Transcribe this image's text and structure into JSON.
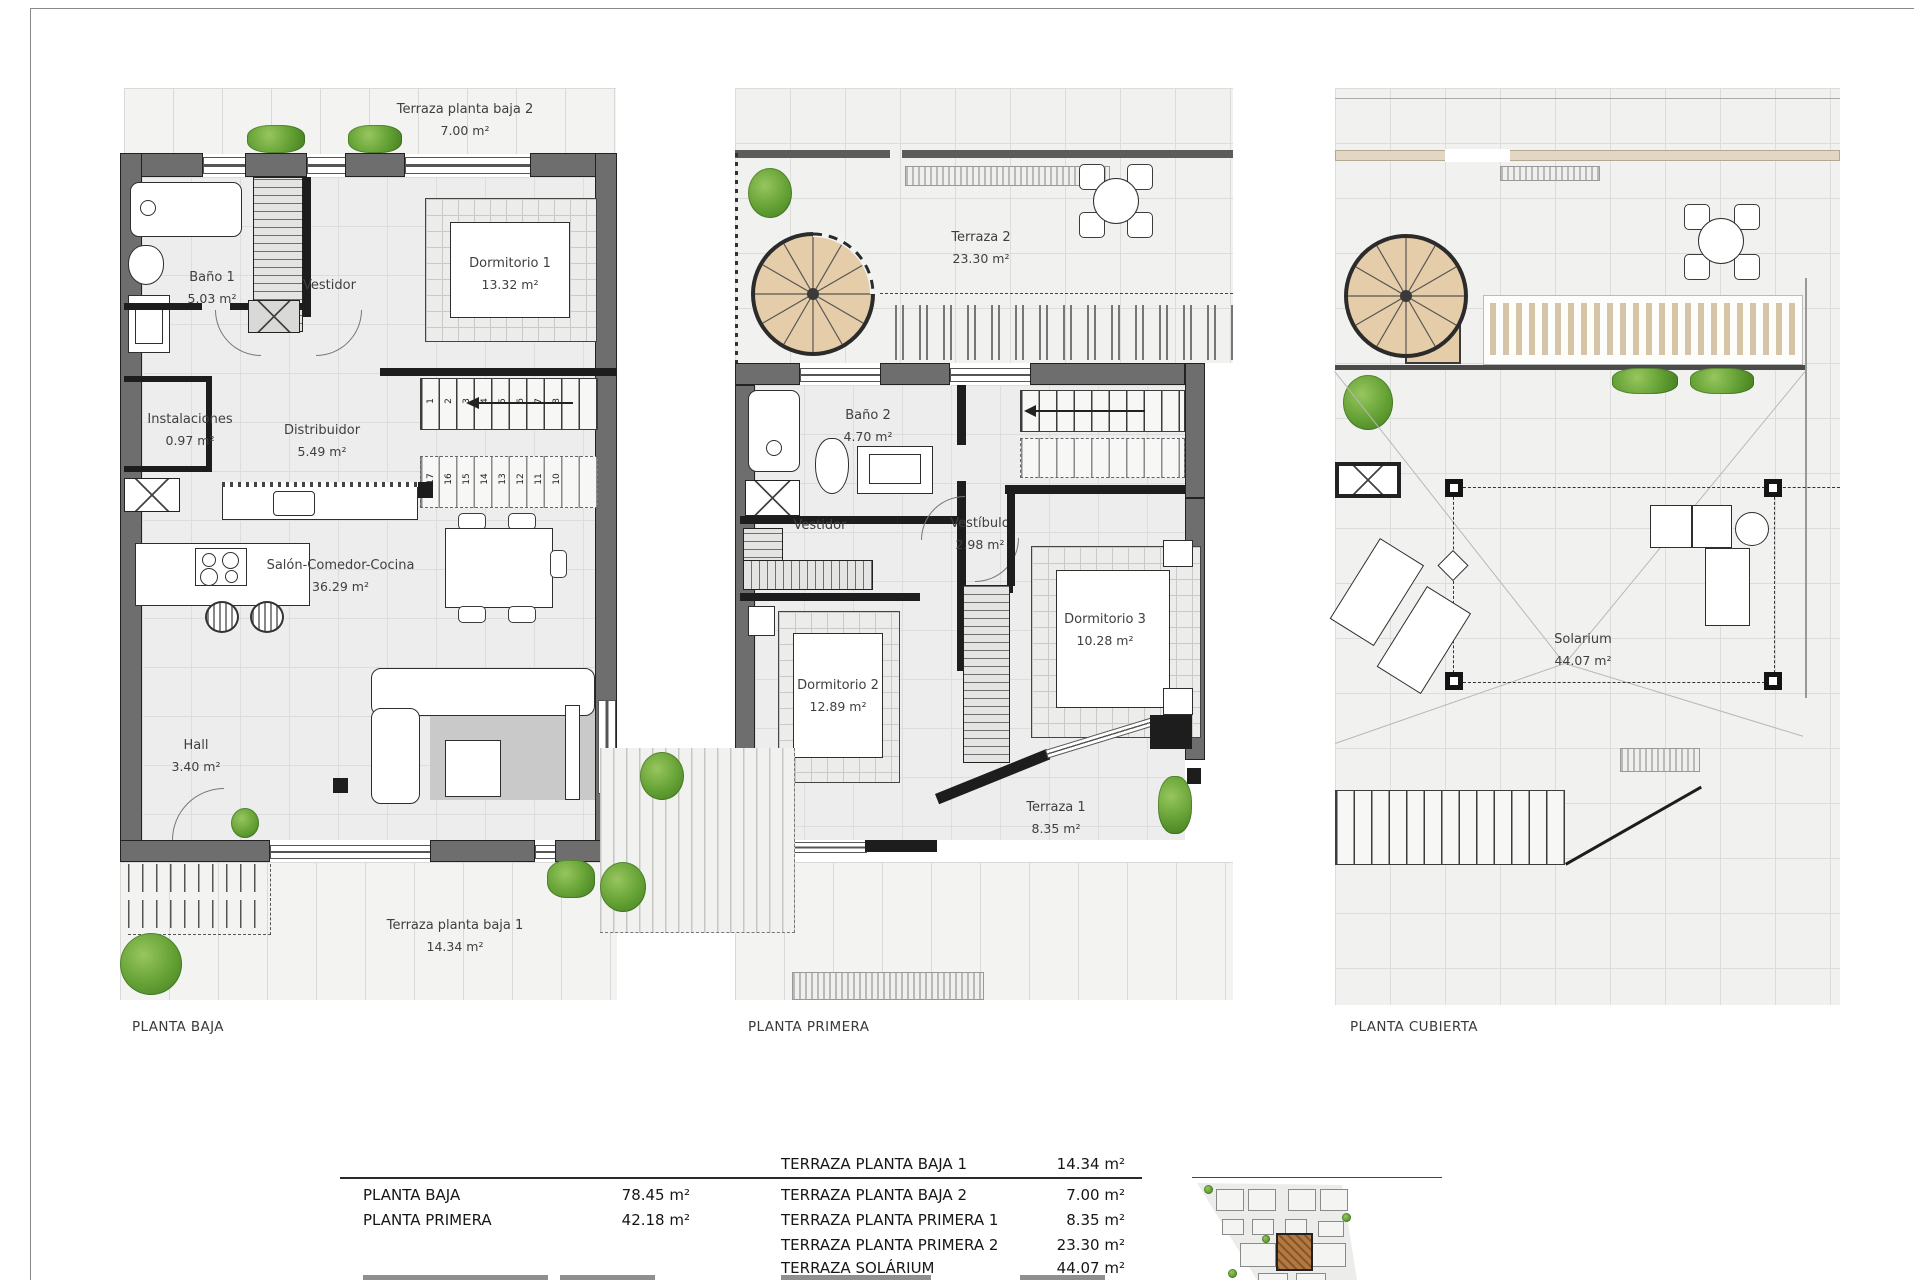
{
  "plans": [
    {
      "title": "PLANTA BAJA",
      "rooms": [
        {
          "name": "Terraza planta baja 2",
          "area": "7.00 m²"
        },
        {
          "name": "Baño 1",
          "area": "5.03 m²"
        },
        {
          "name": "Vestidor"
        },
        {
          "name": "Dormitorio 1",
          "area": "13.32 m²"
        },
        {
          "name": "Instalaciones",
          "area": "0.97 m²"
        },
        {
          "name": "Distribuidor",
          "area": "5.49 m²"
        },
        {
          "name": "Salón-Comedor-Cocina",
          "area": "36.29 m²"
        },
        {
          "name": "Hall",
          "area": "3.40 m²"
        },
        {
          "name": "Terraza planta baja 1",
          "area": "14.34 m²"
        }
      ],
      "stairs": {
        "up": [
          "1",
          "2",
          "3",
          "4",
          "5",
          "6",
          "7",
          "8"
        ],
        "down": [
          "17",
          "16",
          "15",
          "14",
          "13",
          "12",
          "11",
          "10"
        ]
      }
    },
    {
      "title": "PLANTA PRIMERA",
      "rooms": [
        {
          "name": "Terraza 2",
          "area": "23.30 m²"
        },
        {
          "name": "Baño 2",
          "area": "4.70 m²"
        },
        {
          "name": "Vestidor"
        },
        {
          "name": "Vestíbulo",
          "area": "2.98 m²"
        },
        {
          "name": "Dormitorio 2",
          "area": "12.89 m²"
        },
        {
          "name": "Dormitorio 3",
          "area": "10.28 m²"
        },
        {
          "name": "Terraza 1",
          "area": "8.35 m²"
        }
      ]
    },
    {
      "title": "PLANTA CUBIERTA",
      "rooms": [
        {
          "name": "Solarium",
          "area": "44.07 m²"
        }
      ]
    }
  ],
  "summary": {
    "floors": [
      {
        "label": "PLANTA BAJA",
        "value": "78.45 m²"
      },
      {
        "label": "PLANTA PRIMERA",
        "value": "42.18 m²"
      }
    ],
    "terraces": [
      {
        "label": "TERRAZA PLANTA BAJA 1",
        "value": "14.34 m²"
      },
      {
        "label": "TERRAZA PLANTA BAJA 2",
        "value": "7.00 m²"
      },
      {
        "label": "TERRAZA PLANTA PRIMERA 1",
        "value": "8.35 m²"
      },
      {
        "label": "TERRAZA PLANTA PRIMERA 2",
        "value": "23.30 m²"
      },
      {
        "label": "TERRAZA SOLÁRIUM",
        "value": "44.07 m²"
      }
    ]
  },
  "colors": {
    "wall": "#6e6e6e",
    "partition": "#1d1d1d",
    "stair_wood": "#e6cda9",
    "plant": "#63a034",
    "site_highlight": "#b5793f"
  }
}
